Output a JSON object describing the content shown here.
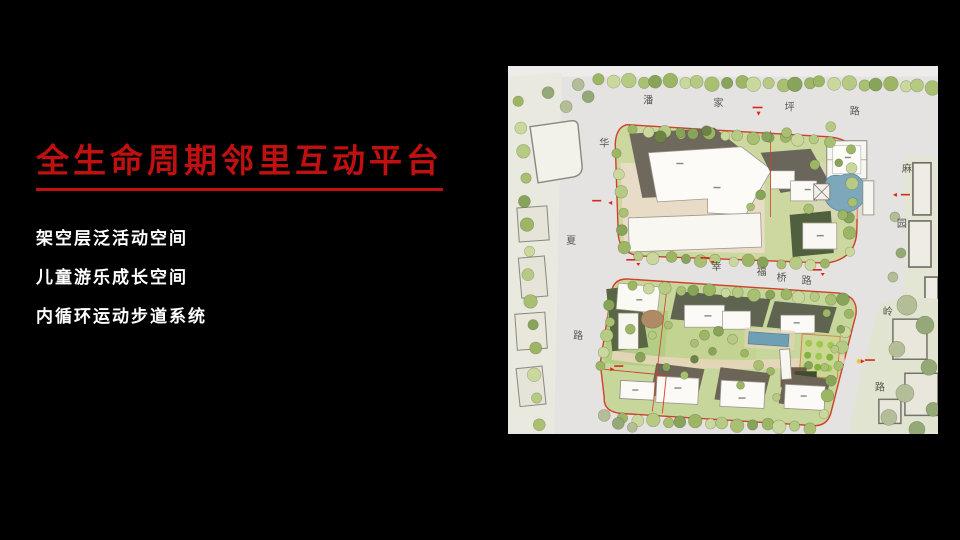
{
  "slide": {
    "background_color": "#000000",
    "title": "全生命周期邻里互动平台",
    "title_color": "#c01010",
    "bullets": [
      "架空层泛活动空间",
      "儿童游乐成长空间",
      "内循环运动步道系统"
    ],
    "bullet_color": "#ffffff"
  },
  "map": {
    "description": "residential-masterplan-site-plan",
    "roads": [
      {
        "name": "潘家坪路",
        "chars": [
          "潘",
          "家",
          "坪",
          "路"
        ],
        "orientation": "horizontal-top"
      },
      {
        "name": "华夏路",
        "chars": [
          "华",
          "夏",
          "路"
        ],
        "orientation": "vertical-left"
      },
      {
        "name": "麻园岭路",
        "chars": [
          "麻",
          "园",
          "岭",
          "路"
        ],
        "orientation": "vertical-right"
      },
      {
        "name": "幸福桥路",
        "chars": [
          "幸",
          "福",
          "桥",
          "路"
        ],
        "orientation": "horizontal-middle"
      }
    ],
    "colors": {
      "parcel_green": "#ccd89f",
      "boundary_red": "#d0402a",
      "pond_blue": "#7da7bb",
      "pool_blue": "#6f9fb5",
      "road_gray": "#e4e3e1",
      "building_shadow": "#6e685d",
      "building_white": "#fbfaf6"
    }
  }
}
